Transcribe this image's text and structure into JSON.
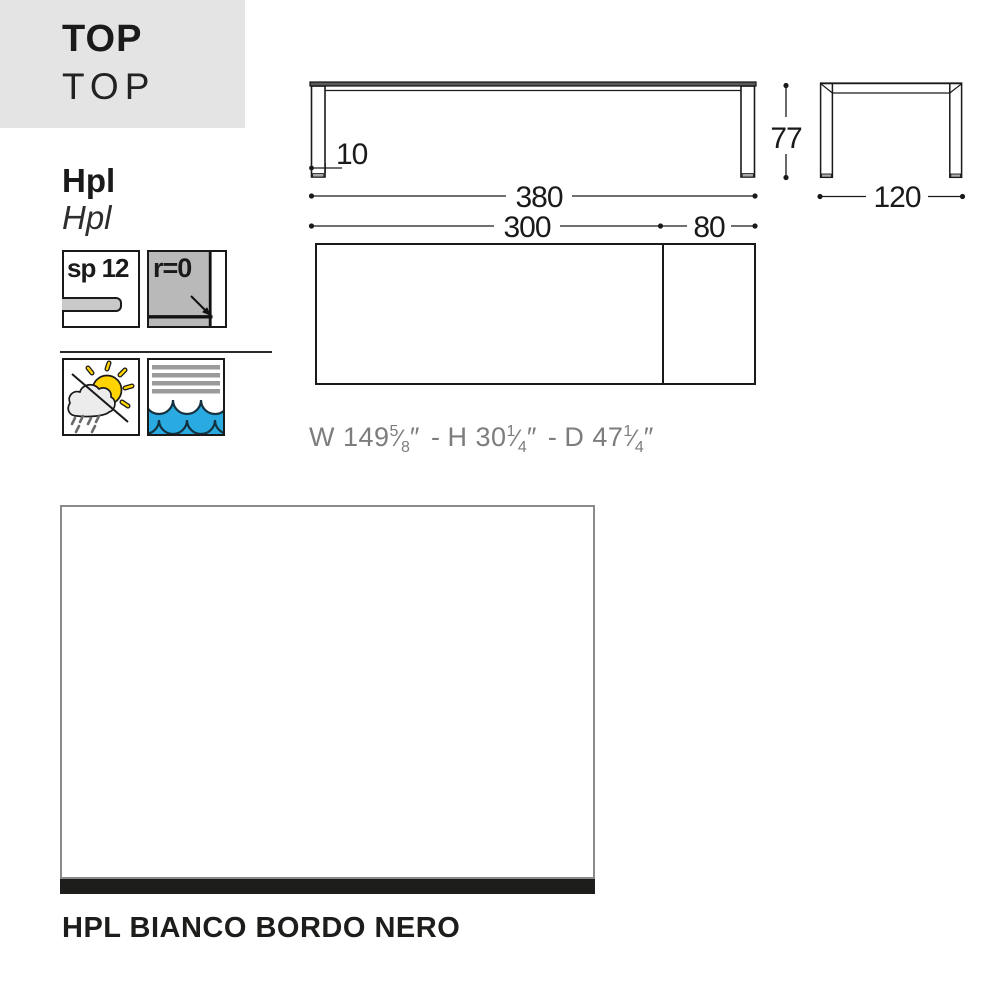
{
  "header": {
    "title": "TOP",
    "title_secondary": "TOP",
    "panel_color": "#e4e4e4"
  },
  "material": {
    "name": "Hpl",
    "name_secondary": "Hpl"
  },
  "specs": {
    "thickness_label": "sp 12",
    "radius_label": "r=0"
  },
  "drawing": {
    "dim_leg_thickness": "10",
    "dim_overall_length": "380",
    "dim_table_length": "300",
    "dim_extension": "80",
    "dim_height": "77",
    "dim_depth": "120"
  },
  "imperial": {
    "w_prefix": "W 149",
    "w_numerator": "5",
    "w_denominator": "8",
    "h_prefix": "H 30",
    "h_numerator": "1",
    "h_denominator": "4",
    "d_prefix": "D 47",
    "d_numerator": "1",
    "d_denominator": "4",
    "unit": "″",
    "separator": "-",
    "slash": "⁄"
  },
  "finish": {
    "label": "HPL BIANCO BORDO NERO",
    "swatch_fill": "#ffffff",
    "edge_color": "#1d1d1b"
  },
  "colors": {
    "line": "#1a1a1a",
    "wave_blue": "#29abe2",
    "sun_yellow": "#ffd400",
    "icon_gray": "#b9b9b9",
    "stripe_gray": "#9b9b9b",
    "swatch_border": "#8a8a8a"
  }
}
